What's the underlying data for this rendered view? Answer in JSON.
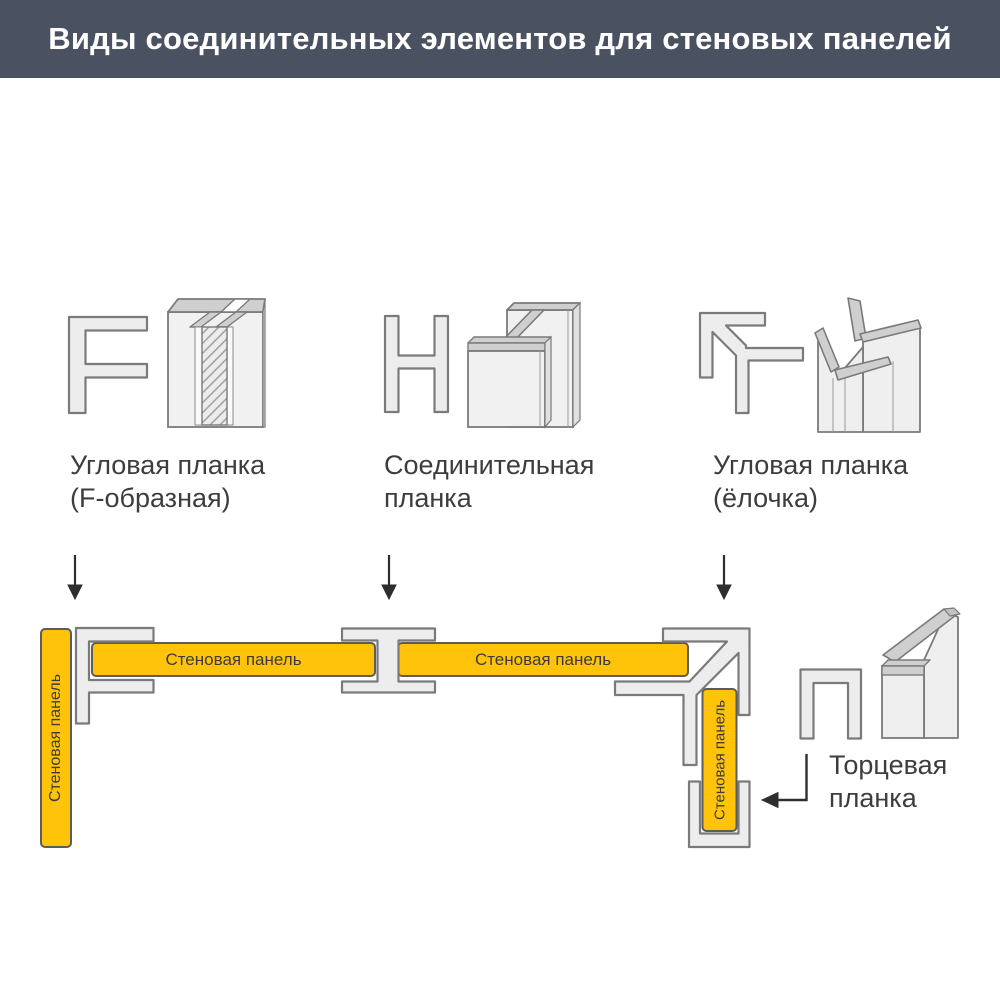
{
  "header": {
    "title": "Виды соединительных элементов для стеновых панелей"
  },
  "profiles": [
    {
      "id": "f-strip",
      "label_line1": "Угловая планка",
      "label_line2": "(F-образная)"
    },
    {
      "id": "h-strip",
      "label_line1": "Соединительная",
      "label_line2": "планка"
    },
    {
      "id": "herringbone-strip",
      "label_line1": "Угловая планка",
      "label_line2": "(ёлочка)"
    }
  ],
  "assembly": {
    "wall_panel_label": "Стеновая панель",
    "end_strip_label_line1": "Торцевая",
    "end_strip_label_line2": "планка"
  },
  "colors": {
    "header_bg": "#4a5261",
    "panel_yellow": "#ffc40a",
    "panel_stroke": "#5c5c5c",
    "profile_fill": "#ededed",
    "profile_stroke": "#7a7a7a",
    "top_face_gray": "#cfcfcf",
    "text": "#3d3d3d",
    "arrow": "#2e2e2e"
  }
}
